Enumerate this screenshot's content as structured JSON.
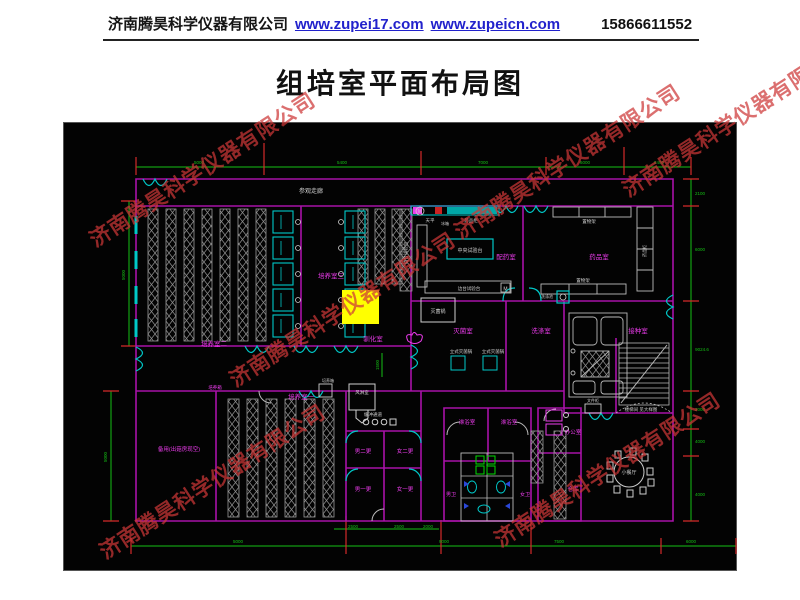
{
  "header": {
    "company": "济南腾昊科学仪器有限公司",
    "site1": "www.zupei17.com",
    "site2": "www.zupeicn.com",
    "phone": "15866611552"
  },
  "title": "组培室平面布局图",
  "watermark": {
    "text": "济南腾昊科学仪器有限公司",
    "color": "#cd3737"
  },
  "plan": {
    "colors": {
      "wall": "#a812a8",
      "cyan": "#00c8c8",
      "green": "#15c015",
      "white": "#cfcfcf",
      "magenta": "#ee3cee",
      "red": "#d42a2a",
      "highlight": "#ffff00"
    },
    "labels": [
      {
        "n": "corridor-label",
        "t": "参观走廊",
        "x": 310,
        "y": 192,
        "c": "w",
        "s": 6
      },
      {
        "n": "room-peiyang2",
        "t": "培养室二",
        "x": 213,
        "y": 345,
        "c": "m",
        "s": 6.5
      },
      {
        "n": "room-peiyang3",
        "t": "培养室三",
        "x": 330,
        "y": 277,
        "c": "m",
        "s": 6.5
      },
      {
        "n": "room-xunhua",
        "t": "驯化室",
        "x": 372,
        "y": 340,
        "c": "m",
        "s": 6.5
      },
      {
        "n": "room-peiyang1",
        "t": "培养室一",
        "x": 300,
        "y": 398,
        "c": "m",
        "s": 6.5
      },
      {
        "n": "tag-peiyangxiang",
        "t": "培养箱",
        "x": 214,
        "y": 388,
        "c": "m",
        "s": 4.5
      },
      {
        "n": "room-beiyong",
        "t": "备用(出菇房现空)",
        "x": 178,
        "y": 450,
        "c": "m",
        "s": 5.5
      },
      {
        "n": "room-peiyao",
        "t": "配药室",
        "x": 505,
        "y": 258,
        "c": "m",
        "s": 6.5
      },
      {
        "n": "room-yaopin",
        "t": "药品室",
        "x": 598,
        "y": 258,
        "c": "m",
        "s": 6.5
      },
      {
        "n": "room-miejun",
        "t": "灭菌室",
        "x": 462,
        "y": 332,
        "c": "m",
        "s": 6.5
      },
      {
        "n": "room-xidi",
        "t": "洗涤室",
        "x": 540,
        "y": 332,
        "c": "m",
        "s": 6.5
      },
      {
        "n": "room-jiezhong",
        "t": "接种室",
        "x": 637,
        "y": 332,
        "c": "m",
        "s": 6.5
      },
      {
        "n": "room-nan2geng",
        "t": "男二更",
        "x": 362,
        "y": 452,
        "c": "m",
        "s": 5.5
      },
      {
        "n": "room-nv2geng",
        "t": "女二更",
        "x": 404,
        "y": 452,
        "c": "m",
        "s": 5.5
      },
      {
        "n": "room-nan1geng",
        "t": "男一更",
        "x": 362,
        "y": 490,
        "c": "m",
        "s": 5.5
      },
      {
        "n": "room-nv1geng",
        "t": "女一更",
        "x": 404,
        "y": 490,
        "c": "m",
        "s": 5.5
      },
      {
        "n": "room-linyu-1",
        "t": "淋浴室",
        "x": 466,
        "y": 423,
        "c": "m",
        "s": 5.5
      },
      {
        "n": "room-linyu-2",
        "t": "淋浴室",
        "x": 508,
        "y": 423,
        "c": "m",
        "s": 5.5
      },
      {
        "n": "room-nanwei",
        "t": "男卫",
        "x": 450,
        "y": 495,
        "c": "m",
        "s": 5
      },
      {
        "n": "room-nvwei",
        "t": "女卫",
        "x": 524,
        "y": 495,
        "c": "m",
        "s": 5
      },
      {
        "n": "room-bangong",
        "t": "办公室",
        "x": 572,
        "y": 433,
        "c": "m",
        "s": 5.5
      },
      {
        "n": "room-cangku",
        "t": "仓库",
        "x": 572,
        "y": 490,
        "c": "m",
        "s": 5.5
      },
      {
        "n": "room-canting",
        "t": "小餐厅",
        "x": 628,
        "y": 473,
        "c": "w",
        "s": 5
      },
      {
        "n": "room-fenglin",
        "t": "风淋室",
        "x": 361,
        "y": 393,
        "c": "w",
        "s": 4.5
      },
      {
        "n": "tag-huanchong",
        "t": "缓冲通道",
        "x": 372,
        "y": 415,
        "c": "w",
        "s": 4.5
      },
      {
        "n": "bench-central",
        "t": "中央试验台",
        "x": 469,
        "y": 251,
        "c": "w",
        "s": 5
      },
      {
        "n": "bench-side-1",
        "t": "边台试验台",
        "x": 468,
        "y": 289,
        "c": "w",
        "s": 4.5
      },
      {
        "n": "bench-side-2",
        "t": "边台试验台",
        "x": 406,
        "y": 252,
        "c": "w",
        "s": 4.5,
        "r": -90
      },
      {
        "n": "tag-tianping",
        "t": "天平",
        "x": 429,
        "y": 221,
        "c": "w",
        "s": 4.5
      },
      {
        "n": "tag-bingxiang",
        "t": "冰箱",
        "x": 444,
        "y": 224,
        "c": "w",
        "s": 4
      },
      {
        "n": "tag-yaopingui",
        "t": "药品柜",
        "x": 470,
        "y": 221,
        "c": "w",
        "s": 4.5
      },
      {
        "n": "tag-miejunguo",
        "t": "灭菌锅",
        "x": 437,
        "y": 312,
        "c": "w",
        "s": 5
      },
      {
        "n": "tag-lishi-1",
        "t": "立式灭菌锅",
        "x": 460,
        "y": 352,
        "c": "w",
        "s": 4.5
      },
      {
        "n": "tag-lishi-2",
        "t": "立式灭菌锅",
        "x": 492,
        "y": 352,
        "c": "w",
        "s": 4.5
      },
      {
        "n": "tag-zhiwujia-1",
        "t": "置物架",
        "x": 588,
        "y": 222,
        "c": "w",
        "s": 4.5
      },
      {
        "n": "tag-zhiwujia-2",
        "t": "置物架",
        "x": 582,
        "y": 281,
        "c": "w",
        "s": 4.5
      },
      {
        "n": "tag-yaogui-vert",
        "t": "药品柜",
        "x": 645,
        "y": 250,
        "c": "w",
        "s": 4,
        "r": -90
      },
      {
        "n": "tag-xidichi",
        "t": "洗涤池",
        "x": 546,
        "y": 297,
        "c": "w",
        "s": 4
      },
      {
        "n": "tag-wenjiangui",
        "t": "文件柜",
        "x": 592,
        "y": 401,
        "c": "w",
        "s": 4
      },
      {
        "n": "tag-peiyangxiang-2",
        "t": "培养箱",
        "x": 327,
        "y": 381,
        "c": "w",
        "s": 4
      },
      {
        "n": "tag-louti",
        "t": "楼梯间 见大样图",
        "x": 640,
        "y": 410,
        "c": "w",
        "s": 4.5
      }
    ],
    "dims": [
      {
        "t": "5000",
        "x": 198,
        "y": 163
      },
      {
        "t": "5400",
        "x": 341,
        "y": 163
      },
      {
        "t": "7000",
        "x": 482,
        "y": 163
      },
      {
        "t": "6000",
        "x": 584,
        "y": 163
      },
      {
        "t": "8400",
        "x": 658,
        "y": 163
      },
      {
        "t": "5000",
        "x": 124,
        "y": 274,
        "r": -90
      },
      {
        "t": "5000",
        "x": 106,
        "y": 456,
        "r": -90
      },
      {
        "t": "2100",
        "x": 699,
        "y": 194
      },
      {
        "t": "6000",
        "x": 699,
        "y": 250
      },
      {
        "t": "9024.6",
        "x": 701,
        "y": 350
      },
      {
        "t": "2000",
        "x": 699,
        "y": 410
      },
      {
        "t": "4000",
        "x": 699,
        "y": 442
      },
      {
        "t": "4000",
        "x": 699,
        "y": 495
      },
      {
        "t": "5000",
        "x": 237,
        "y": 542
      },
      {
        "t": "9000",
        "x": 443,
        "y": 542
      },
      {
        "t": "7500",
        "x": 558,
        "y": 542
      },
      {
        "t": "6000",
        "x": 690,
        "y": 542
      },
      {
        "t": "2500",
        "x": 352,
        "y": 527
      },
      {
        "t": "2500",
        "x": 398,
        "y": 527
      },
      {
        "t": "2000",
        "x": 427,
        "y": 527
      },
      {
        "t": "1500",
        "x": 378,
        "y": 364,
        "r": -90
      }
    ]
  }
}
